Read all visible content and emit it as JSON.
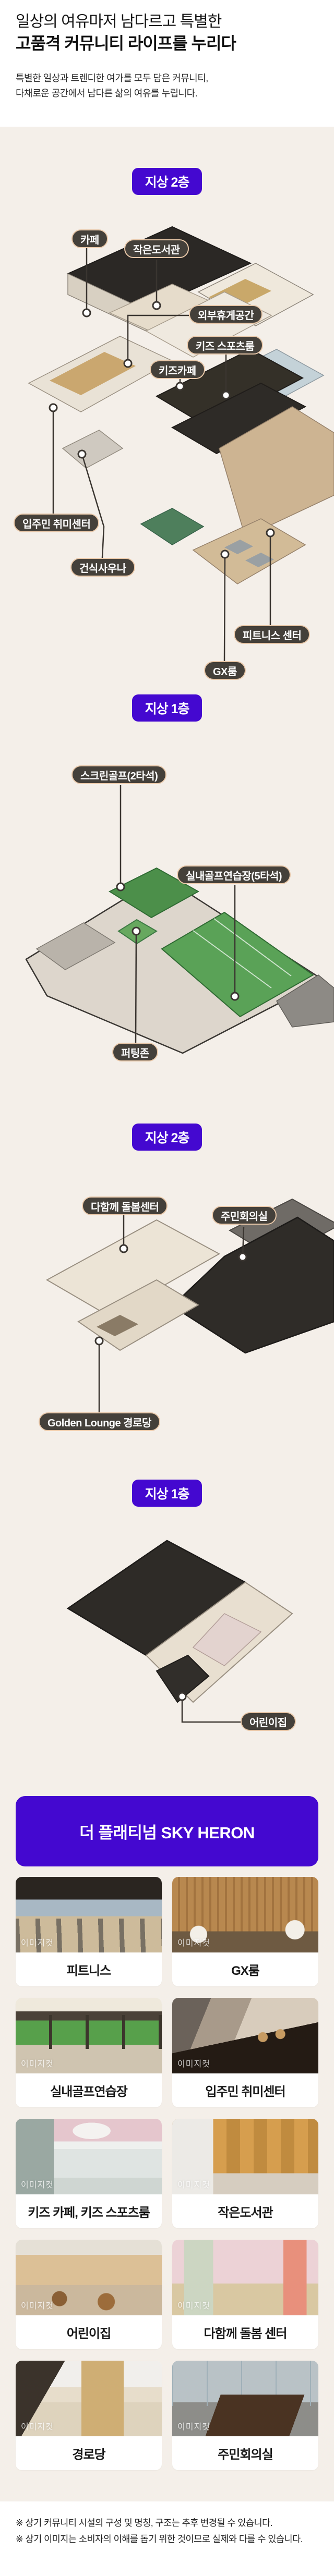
{
  "header": {
    "title_line1": "일상의 여유마저 남다르고 특별한",
    "title_line2": "고품격 커뮤니티 라이프를 누리다",
    "subtitle_line1": "특별한 일상과 트렌디한 여가를 모두 담은 커뮤니티,",
    "subtitle_line2": "다채로운 공간에서 남다른 삶의 여유를 누립니다."
  },
  "sections": [
    {
      "badge": "지상 2층",
      "labels": [
        "카페",
        "작은도서관",
        "외부휴게공간",
        "키즈 스포츠룸",
        "키즈카페",
        "입주민 취미센터",
        "건식사우나",
        "피트니스 센터",
        "GX룸"
      ]
    },
    {
      "badge": "지상 1층",
      "labels": [
        "스크린골프(2타석)",
        "실내골프연습장(5타석)",
        "퍼팅존"
      ]
    },
    {
      "badge": "지상 2층",
      "labels": [
        "다함께 돌봄센터",
        "주민회의실",
        "Golden Lounge 경로당"
      ]
    },
    {
      "badge": "지상 1층",
      "labels": [
        "어린이집"
      ]
    }
  ],
  "banner": {
    "title": "더 플래티넘 SKY HERON"
  },
  "gallery": {
    "watermark": "이미지컷",
    "cards": [
      {
        "caption": "피트니스"
      },
      {
        "caption": "GX룸"
      },
      {
        "caption": "실내골프연습장"
      },
      {
        "caption": "입주민 취미센터"
      },
      {
        "caption": "키즈 카페, 키즈 스포츠룸"
      },
      {
        "caption": "작은도서관"
      },
      {
        "caption": "어린이집"
      },
      {
        "caption": "다함께 돌봄 센터"
      },
      {
        "caption": "경로당"
      },
      {
        "caption": "주민회의실"
      }
    ]
  },
  "footer": {
    "note1": "※ 상기 커뮤니티 시설의 구성 및 명칭, 구조는 추후 변경될 수 있습니다.",
    "note2": "※ 상기 이미지는 소비자의 이해를 돕기 위한 것이므로 실제와 다를 수 있습니다."
  },
  "colors": {
    "accent_purple": "#4408d0",
    "beige_background": "#f4efe9",
    "pill_background": "#44403a",
    "pill_border": "#e9c8a9"
  }
}
